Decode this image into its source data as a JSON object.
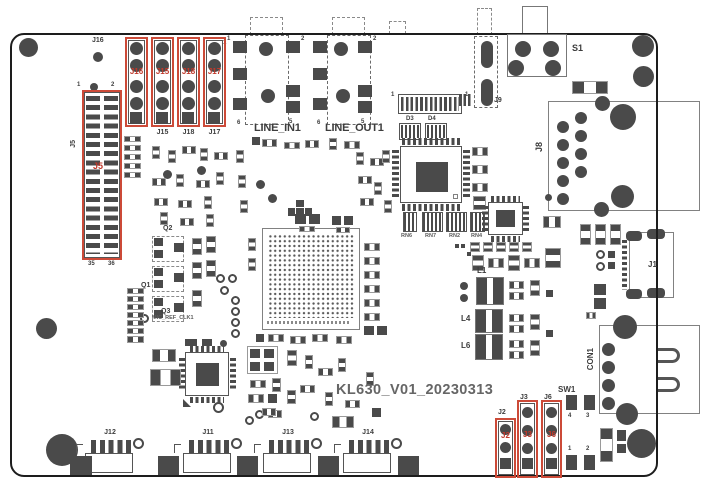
{
  "board": {
    "title": "KL630_V01_20230313"
  },
  "topHeaders": {
    "h1Silk": "J16",
    "h2Silk": "J15",
    "h3Silk": "J18",
    "h4Silk": "J17",
    "h1Red": "J16",
    "h2Red": "J15",
    "h3Red": "J18",
    "h4Red": "J17",
    "pin1": "1"
  },
  "j5": {
    "silk": "J5",
    "red": "J5",
    "pinTL": "1",
    "pinTR": "2",
    "pinBL": "35",
    "pinBR": "36"
  },
  "audio": {
    "lineIn": "LINE_IN1",
    "lineOut": "LINE_OUT1",
    "inPinTL": "1",
    "inPinTR": "2",
    "inPinBL": "6",
    "inPinBR": "5",
    "outPinTR": "2",
    "outPinBL": "6",
    "outPinBR": "5"
  },
  "topConn": {
    "pin1Left": "1",
    "pin1Right": "1"
  },
  "diodes": {
    "d3": "D3",
    "d4": "D4"
  },
  "topRight": {
    "s1": "S1",
    "j9": "J9"
  },
  "rightSide": {
    "j8": "J8",
    "j1": "J1",
    "con1": "CON1"
  },
  "transistors": {
    "q1": "Q1",
    "q2": "Q2",
    "q3": "Q3",
    "micRefClk": "MIC_REF_CLK1"
  },
  "resistorNetworks": {
    "rn6": "RN6",
    "rn7": "RN7",
    "rn2": "RN2",
    "rn4": "RN4"
  },
  "inductors": {
    "l1": "L1",
    "l4": "L4",
    "l6": "L6"
  },
  "bottomConnectors": {
    "j12": "J12",
    "j11": "J11",
    "j13": "J13",
    "j14": "J14"
  },
  "bottomRight": {
    "j2Silk": "J2",
    "j3Silk": "J3",
    "j6Silk": "J6",
    "j2Red": "J2",
    "j3Red": "J3",
    "j6Red": "J6",
    "sw1": "SW1",
    "sw1Pin4": "4",
    "sw1Pin3": "3",
    "sw1Pin1": "1",
    "sw1Pin2": "2"
  }
}
